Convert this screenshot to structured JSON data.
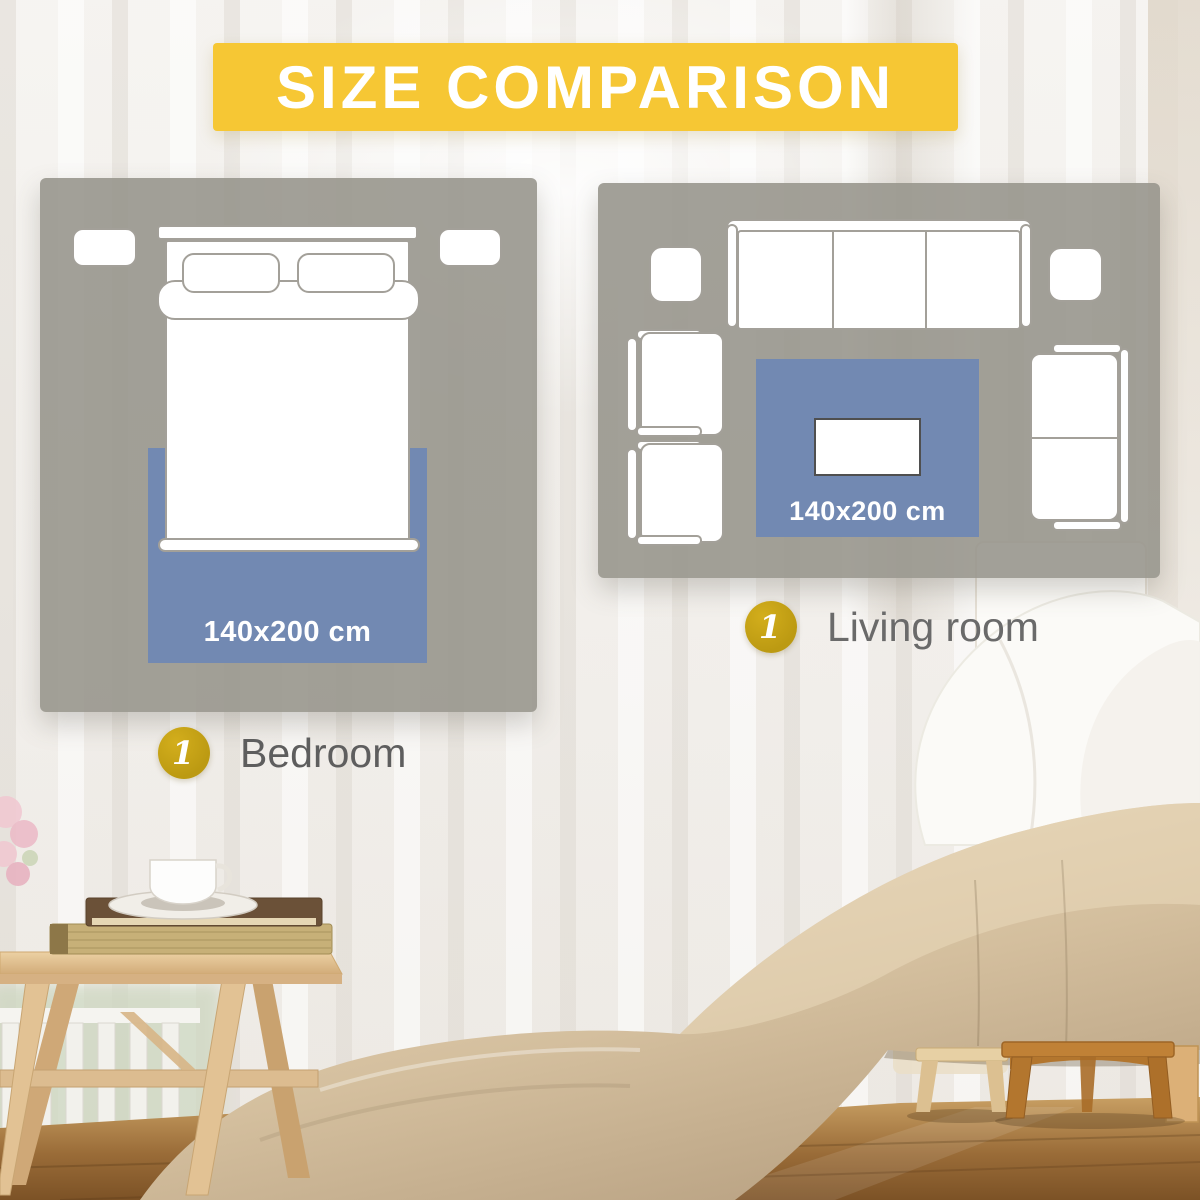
{
  "banner": {
    "title": "SIZE COMPARISON"
  },
  "bedroom_panel": {
    "rug_size": "140x200 cm",
    "marker": "1",
    "label": "Bedroom"
  },
  "living_panel": {
    "rug_size": "140x200 cm",
    "marker": "1",
    "label": "Living room"
  },
  "colors": {
    "banner_yellow": "#F6C734",
    "rug_blue": "#7289B2",
    "marker_gold": "#BC9A12",
    "panel_gray": "#9B9990",
    "bedroom_label": "#5E5E5E",
    "living_label": "#6A6A6A"
  }
}
